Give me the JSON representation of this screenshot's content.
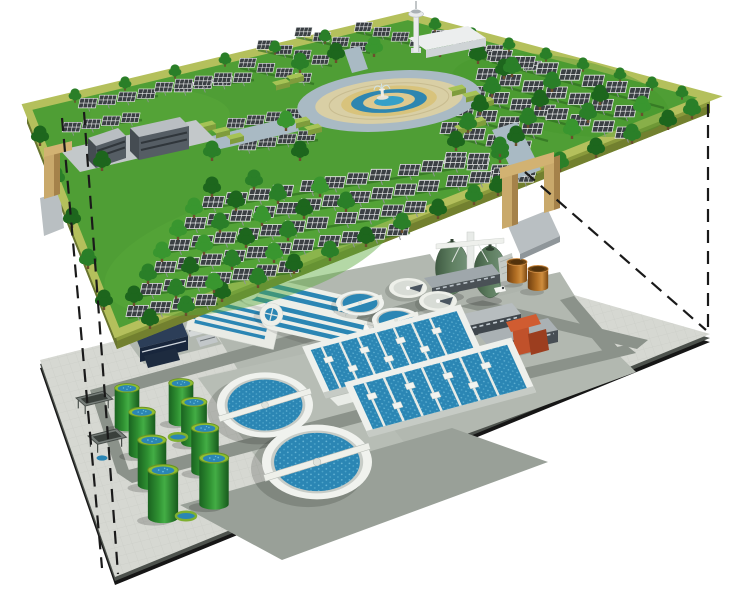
{
  "canvas": {
    "width": 740,
    "height": 589,
    "background": "#ffffff"
  },
  "palette": {
    "grass": "#4f9e35",
    "grassLight": "#58a93a",
    "deckEdgeTop": "#b4c05c",
    "deckEdgeSide": "#8a9a3c",
    "treeDark": "#1d661d",
    "treeMid": "#2a7f28",
    "treeLight": "#39962f",
    "panelDark": "#3a3f43",
    "panelFrame": "#e8eaea",
    "plazaRing": "#a9bac4",
    "plazaPave": "#d9cfa5",
    "fountainBlue": "#35a0c8",
    "paving": "#d6d8d2",
    "road": "#8b928a",
    "pad": "#b2b8b0",
    "padDark": "#99a098",
    "slabEdge": "#161616",
    "concrete": "#f0f2ee",
    "water": "#2b86b4",
    "tankGreen": "#2f9132",
    "tankRim": "#8fbe30",
    "eggGreen": "#5f7f61",
    "brownTank": "#b26f24",
    "redStructure": "#c0512b",
    "navyBuilding": "#2c3e58",
    "archTan": "#c9a96b",
    "dashLine": "#1a1a1a"
  },
  "scene": {
    "type": "isometric-cutaway-illustration",
    "subject": "Solar park built on a deck above an underground wastewater treatment plant",
    "upper_layer": {
      "label": "ground-level solar park deck",
      "features": [
        "rows of solar panel arrays on posts",
        "rows of trees and hedges",
        "central circular plaza with tiered fountain and ring pond",
        "observation tower with white service building",
        "two office buildings on a paved pad",
        "tan gateway arches with ramps",
        "raised green deck with olive side walls"
      ]
    },
    "lower_layer": {
      "label": "underground wastewater treatment plant",
      "features": [
        "2 large secondary clarifiers with rotating bridges",
        "2 small primary clarifiers",
        "2 gravity thickeners",
        "2 oxidation ditches",
        "1 grit channel",
        "2 aeration basin blocks with lane dividers",
        "8 green sludge storage tanks",
        "2 egg-shaped anaerobic digesters with service tower",
        "2 brown storage tanks",
        "blower building with twin white domes",
        "service buildings and red pump structure",
        "2 canopy shelters",
        "paved apron with gray ring roads"
      ]
    },
    "connectors": {
      "label": "dashed projection lines linking the two levels",
      "count": 4
    }
  }
}
